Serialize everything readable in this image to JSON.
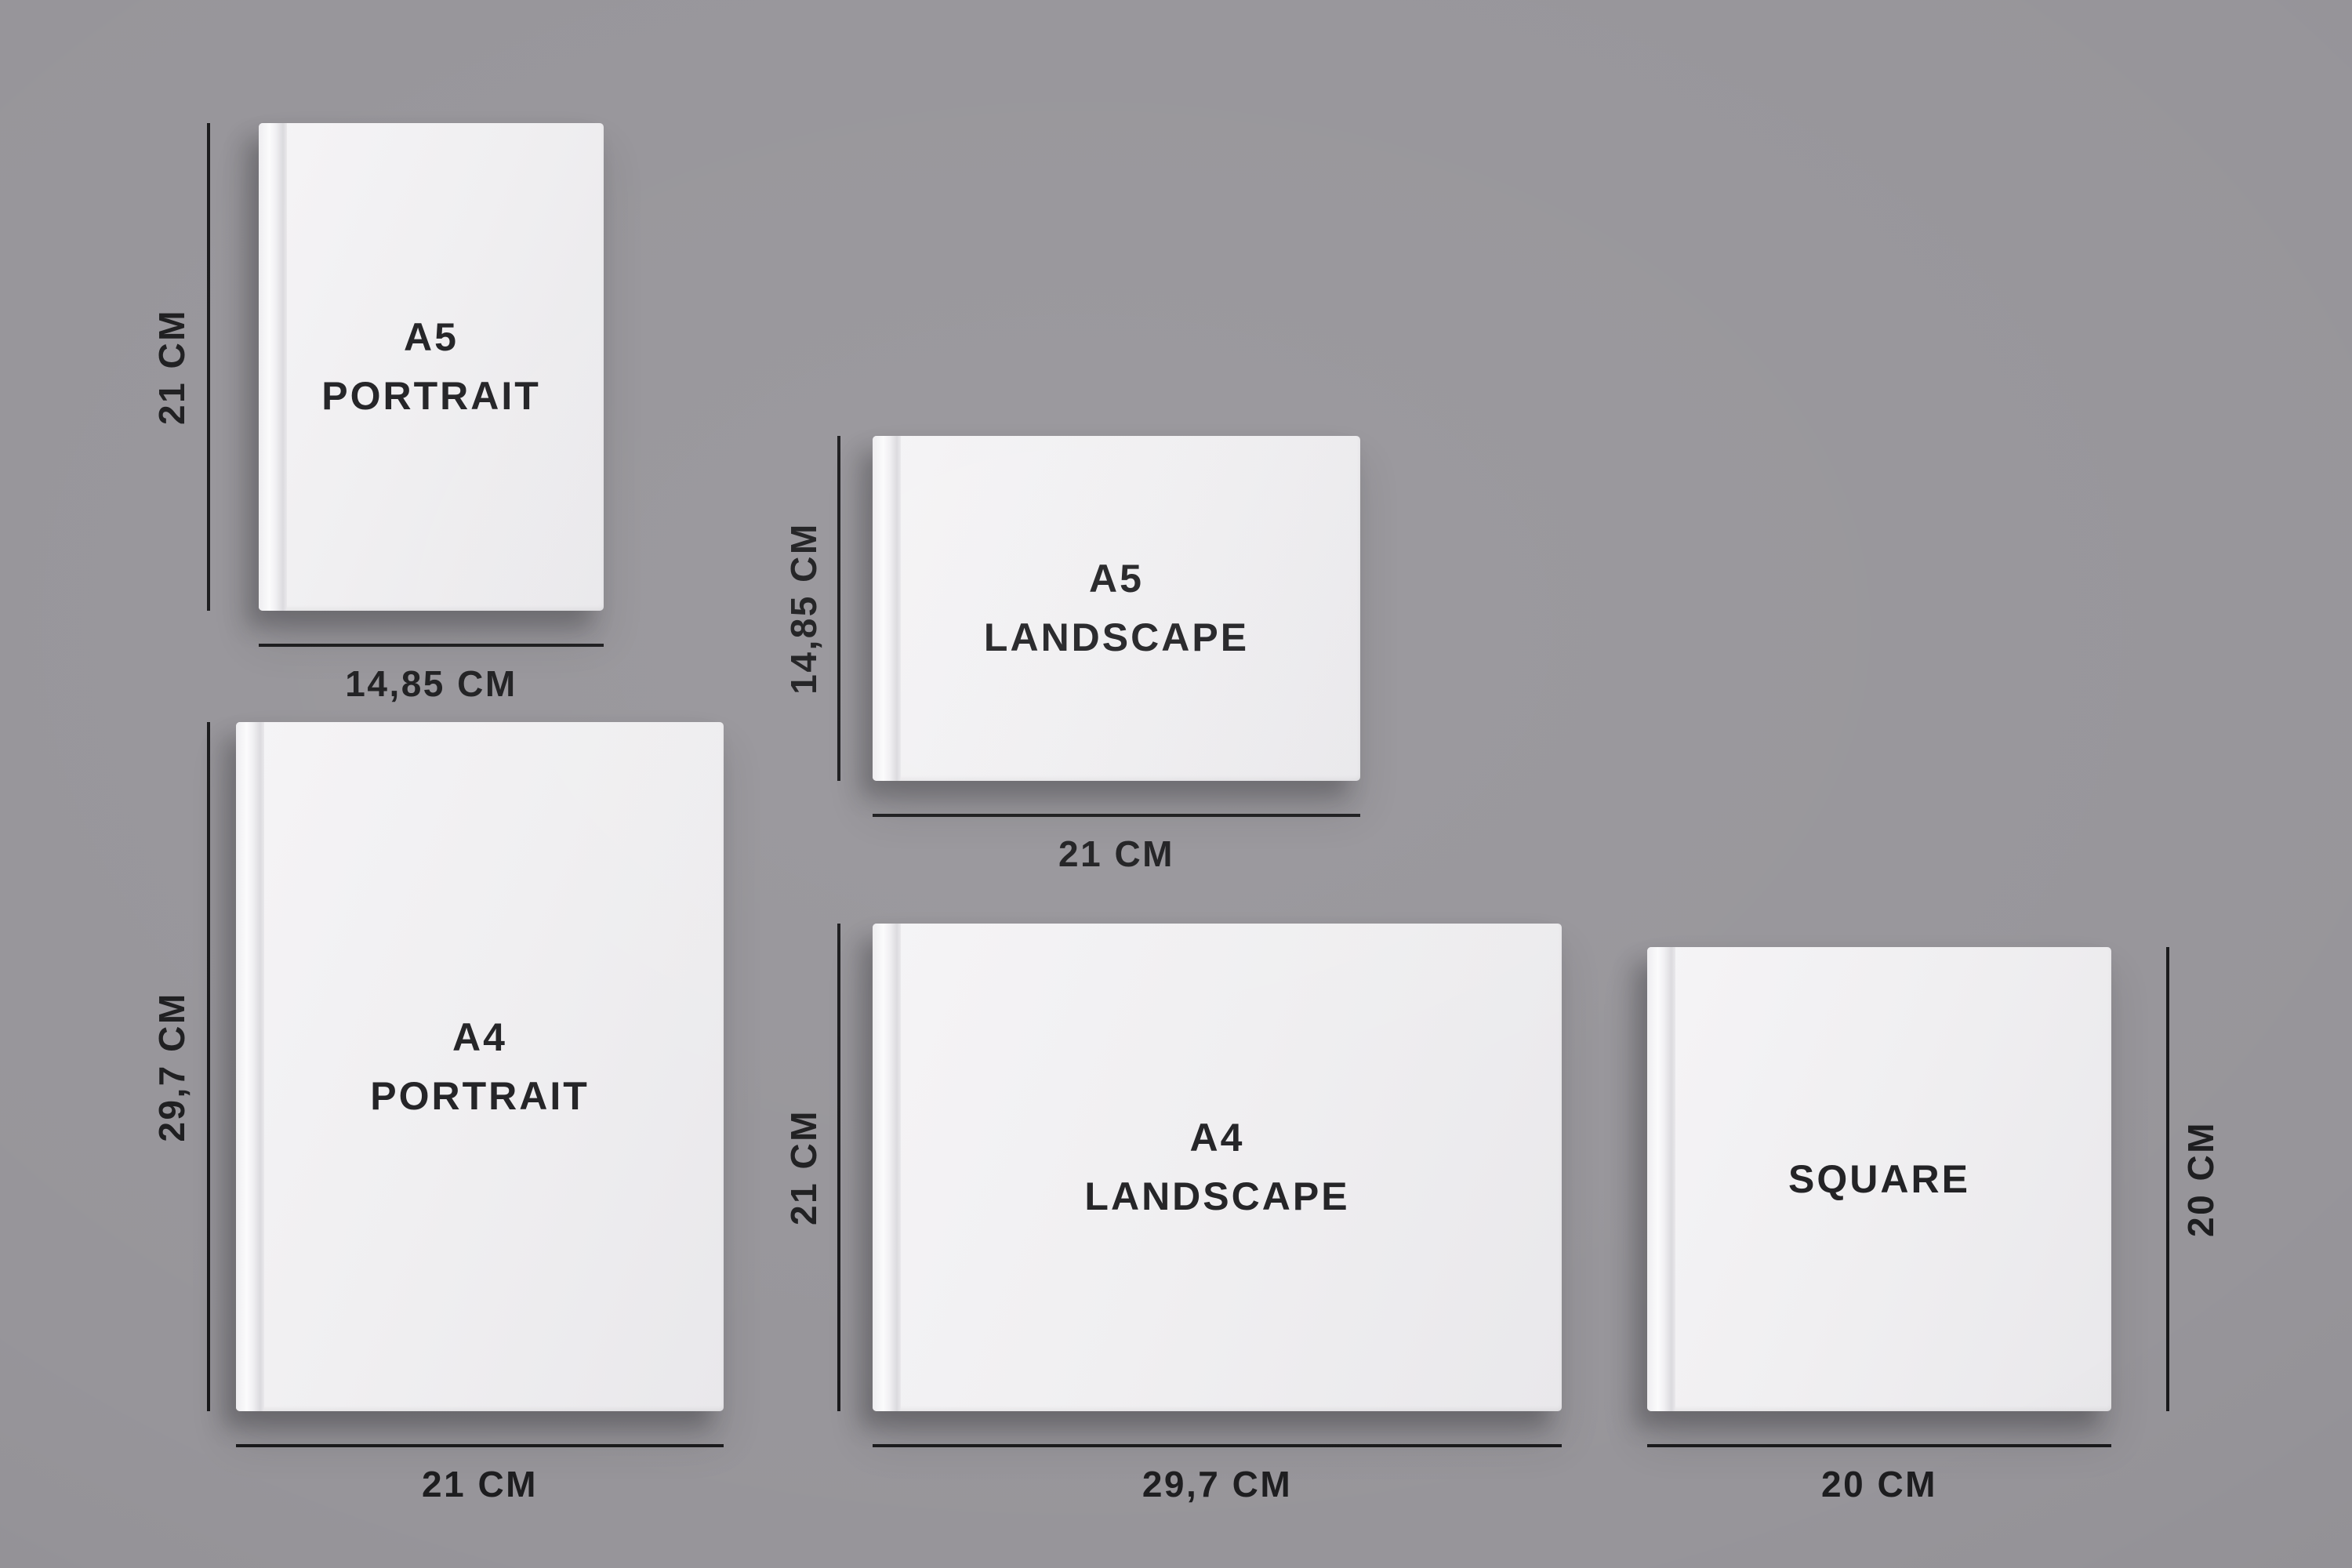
{
  "page": {
    "background_color": "#97959a",
    "line_color": "#19191b",
    "text_color": "#1d1d1f",
    "cover_color": "#f1f0f2"
  },
  "books": [
    {
      "id": "a5-portrait",
      "label": "A5\nPORTRAIT",
      "height_label": "21 CM",
      "width_label": "14,85 CM"
    },
    {
      "id": "a5-landscape",
      "label": "A5\nLANDSCAPE",
      "height_label": "14,85 CM",
      "width_label": "21 CM"
    },
    {
      "id": "a4-portrait",
      "label": "A4\nPORTRAIT",
      "height_label": "29,7 CM",
      "width_label": "21 CM"
    },
    {
      "id": "a4-landscape",
      "label": "A4\nLANDSCAPE",
      "height_label": "21 CM",
      "width_label": "29,7 CM"
    },
    {
      "id": "square",
      "label": "SQUARE",
      "height_label": "20 CM",
      "width_label": "20 CM"
    }
  ]
}
